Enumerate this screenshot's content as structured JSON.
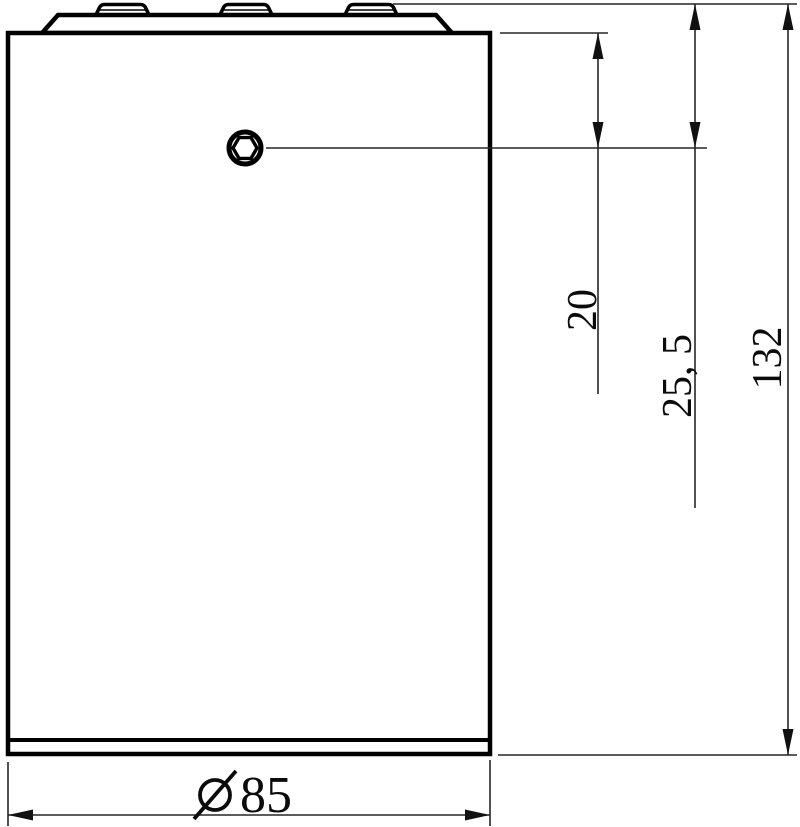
{
  "drawing": {
    "view": "side-view-cylindrical-part-with-top-cap-and-hex-socket-screw",
    "background_color": "#ffffff",
    "part_line_color": "#000000",
    "dimension_line_color": "#262626",
    "labels": {
      "screw_offset_from_body_top": "20",
      "screw_offset_from_cap_top": "25, 5",
      "overall_height": "132",
      "diameter_symbol": "Ø",
      "diameter_value": "85"
    }
  }
}
